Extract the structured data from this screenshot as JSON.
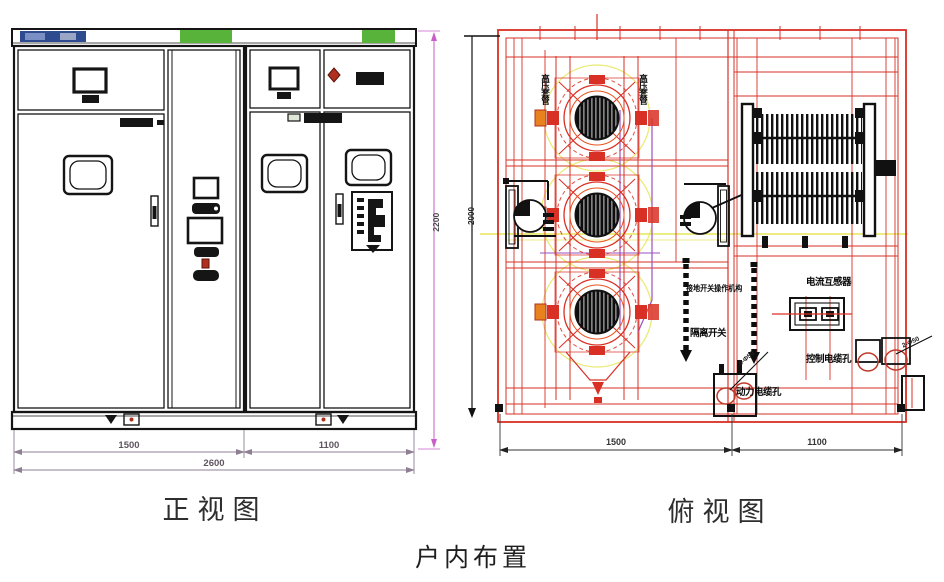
{
  "captions": {
    "front_view": "正视图",
    "top_view": "俯视图",
    "overall": "户内布置"
  },
  "front_view": {
    "dim_height": "2200",
    "dim_left": "1500",
    "dim_right": "1100",
    "dim_total": "2600"
  },
  "top_view": {
    "dim_depth": "2000",
    "dim_left": "1500",
    "dim_right": "1100",
    "labels": {
      "bushing_left": "高压套管",
      "bushing_right": "高压套管",
      "es_mechanism": "接地开关操作机构",
      "disconnector": "隔离开关",
      "current_transformer": "电流互感器",
      "control_cable_hole": "控制电缆孔",
      "power_cable_hole": "动力电缆孔",
      "hole_note_power": "4-Φ50",
      "hole_note_control": "2-Φ50"
    }
  },
  "colors": {
    "drawing_black": "#151515",
    "cad_red": "#d93025",
    "cad_yellow": "#e6e65a",
    "cad_purple": "#9b4fc0",
    "cad_orange": "#e8821e",
    "cabinet_green": "#57b33a",
    "nameplate_blue": "#2e4b8f",
    "dim_magenta": "#c75fc7"
  }
}
